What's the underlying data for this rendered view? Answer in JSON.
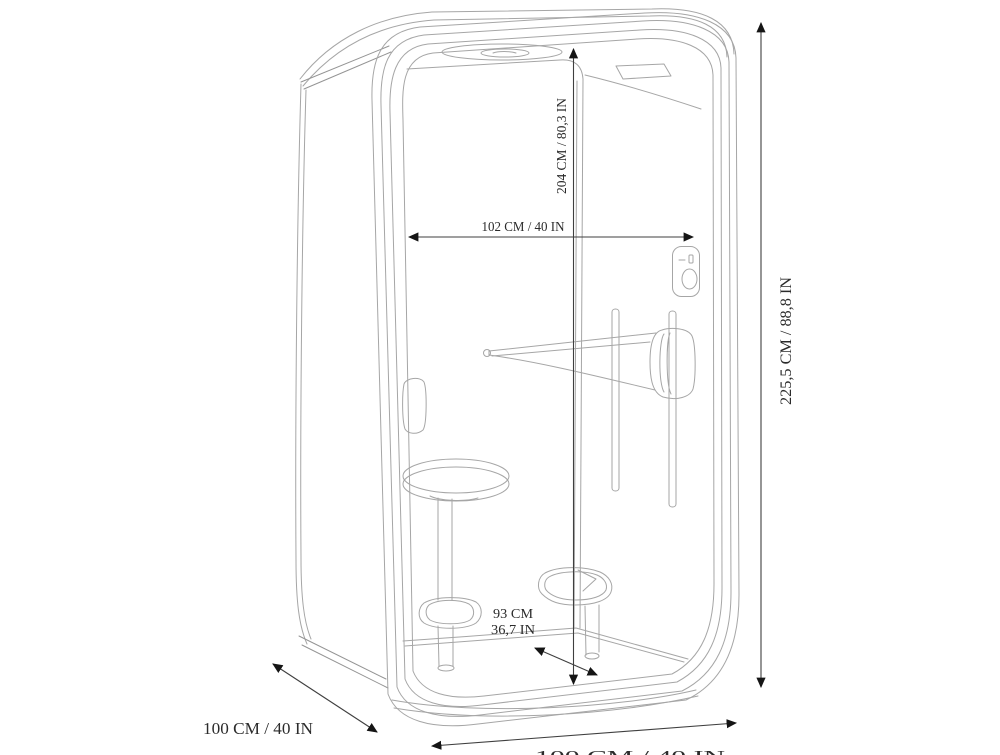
{
  "diagram": {
    "subject": "office-phone-booth-dimension-drawing",
    "dims": {
      "interior_height": "204 CM / 80,3 IN",
      "interior_width": "102 CM / 40 IN",
      "exterior_height": "225,5 CM / 88,8 IN",
      "seat_height_cm": "93 CM",
      "seat_height_in": "36,7 IN",
      "exterior_depth": "100 CM / 40 IN",
      "exterior_width_bottom": "100 CM / 40 IN"
    },
    "colors": {
      "background": "#ffffff",
      "drawing_line": "#a6a6a6",
      "dimension_line": "#3f3f3f",
      "arrowhead": "#151515",
      "text": "#2b2b2b"
    }
  }
}
